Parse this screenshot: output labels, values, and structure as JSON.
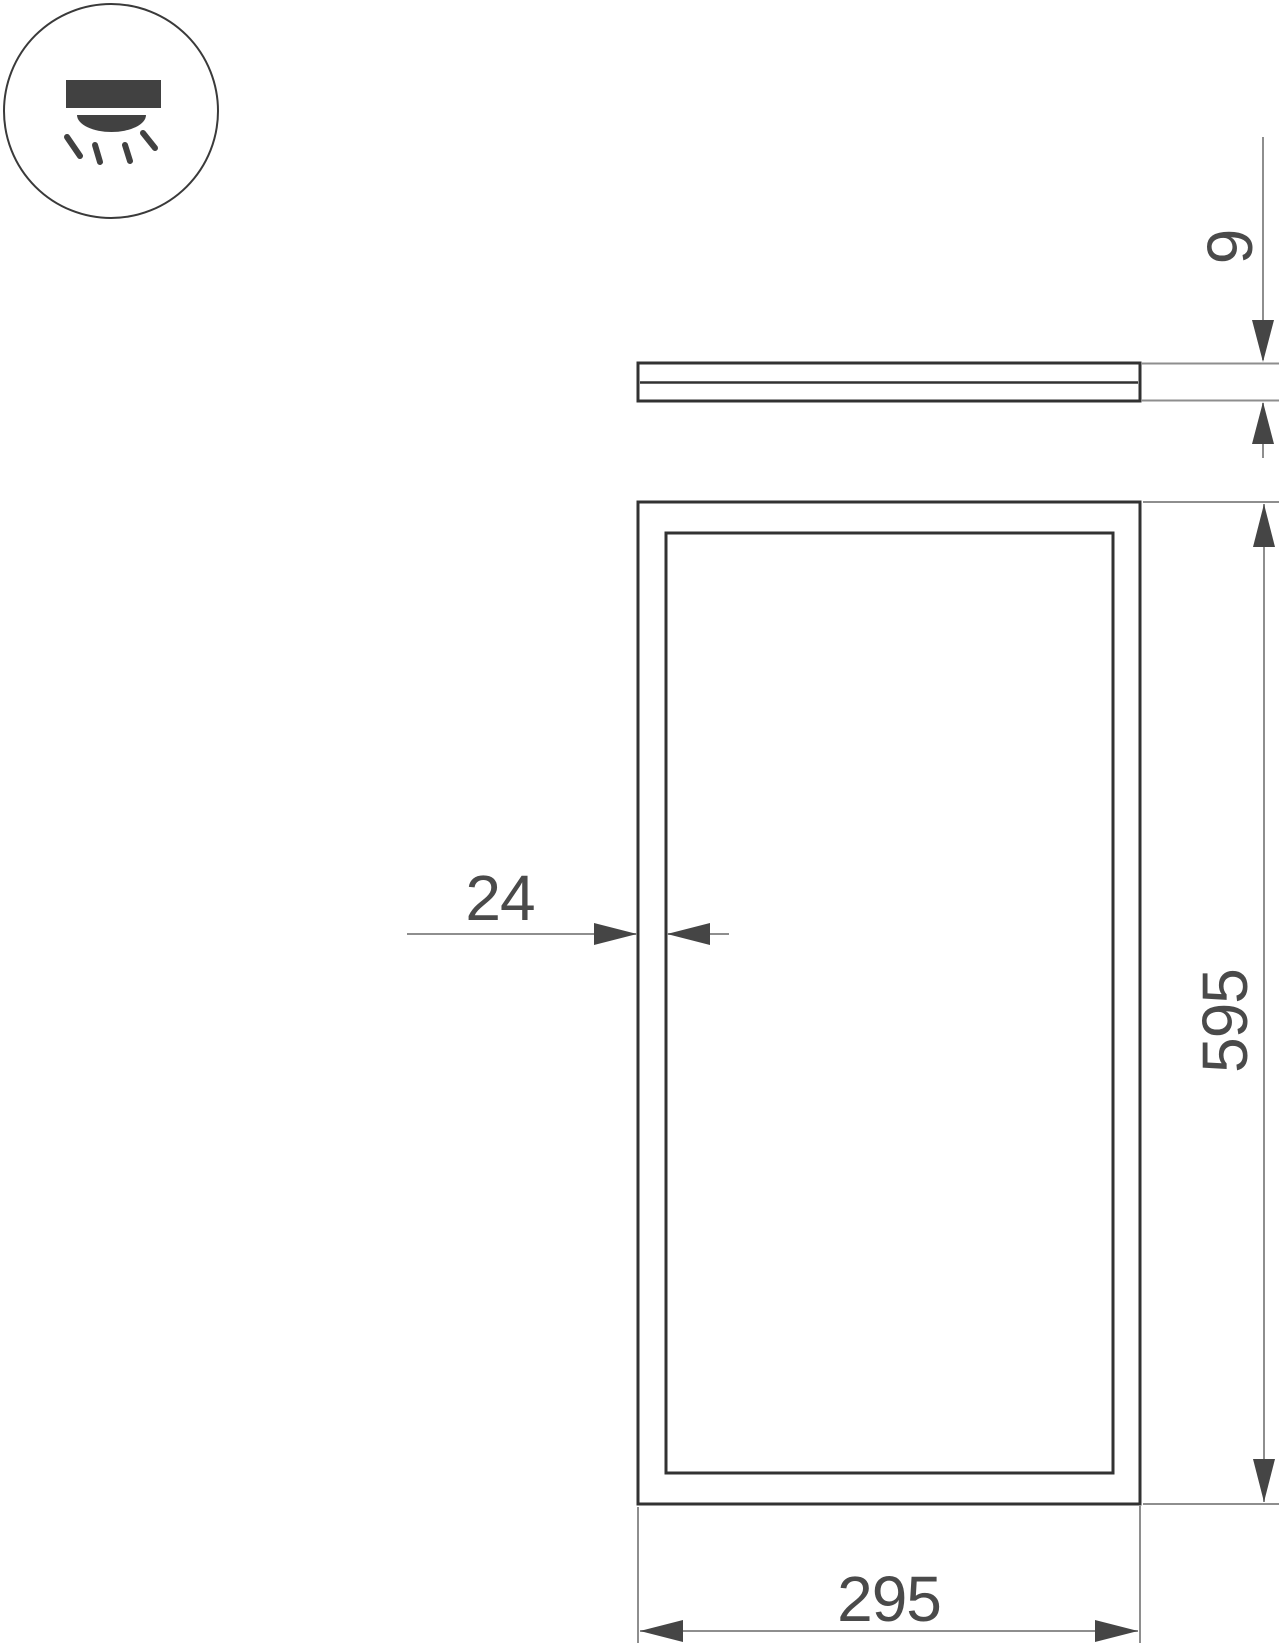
{
  "page": {
    "width_px": 1280,
    "height_px": 1647,
    "background": "#ffffff"
  },
  "drawing": {
    "icon": {
      "name": "surface-downlight-icon"
    },
    "dimensions": {
      "thickness": "9",
      "frame_width": "24",
      "height": "595",
      "width": "295"
    },
    "colors": {
      "outline": "#323232",
      "dimension_line": "#8e8e8e",
      "arrow_and_text": "#454545",
      "icon_fill": "#414141"
    }
  }
}
